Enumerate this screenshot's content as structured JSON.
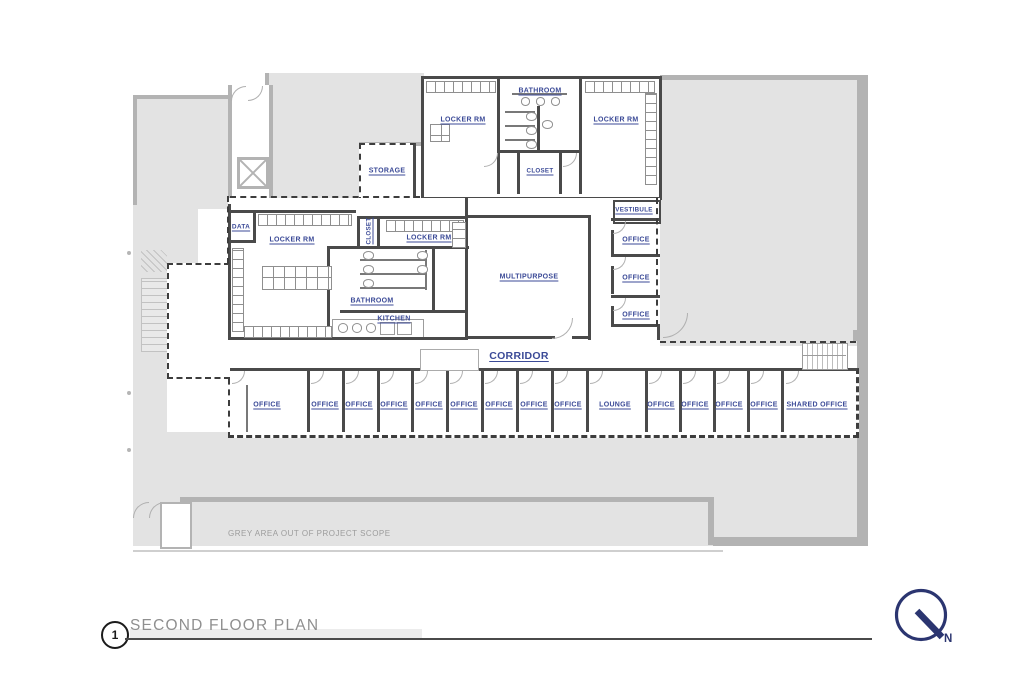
{
  "sheet": {
    "detail_number": "1",
    "title": "SECOND FLOOR PLAN",
    "north_label": "N",
    "scope_note": "GREY AREA OUT OF PROJECT SCOPE"
  },
  "colors": {
    "room_label": "#3b4a97",
    "wall": "#4a4a4a",
    "out_of_scope_fill": "#e3e3e3",
    "out_of_scope_wall": "#b3b3b3",
    "north_arrow": "#2b3570",
    "title_text": "#8f8f8f"
  },
  "rooms": [
    {
      "id": "locker-rm-top-left",
      "label": "LOCKER RM",
      "x": 463,
      "y": 120
    },
    {
      "id": "bathroom-top",
      "label": "BATHROOM",
      "x": 540,
      "y": 91
    },
    {
      "id": "locker-rm-top-right",
      "label": "LOCKER RM",
      "x": 616,
      "y": 120
    },
    {
      "id": "storage",
      "label": "STORAGE",
      "x": 387,
      "y": 171
    },
    {
      "id": "closet-top",
      "label": "CLOSET",
      "x": 540,
      "y": 171,
      "fs": 6.2
    },
    {
      "id": "vestibule",
      "label": "VESTIBULE",
      "x": 634,
      "y": 210,
      "fs": 6.2
    },
    {
      "id": "data",
      "label": "DATA",
      "x": 241,
      "y": 227,
      "fs": 6.5
    },
    {
      "id": "locker-rm-mid-left",
      "label": "LOCKER RM",
      "x": 292,
      "y": 240
    },
    {
      "id": "closet-mid",
      "label": "CLOSET",
      "x": 369,
      "y": 231,
      "fs": 6.2,
      "rot": -90
    },
    {
      "id": "locker-rm-mid-right",
      "label": "LOCKER RM",
      "x": 429,
      "y": 238
    },
    {
      "id": "office-east-1",
      "label": "OFFICE",
      "x": 636,
      "y": 240
    },
    {
      "id": "multipurpose",
      "label": "MULTIPURPOSE",
      "x": 529,
      "y": 277
    },
    {
      "id": "office-east-2",
      "label": "OFFICE",
      "x": 636,
      "y": 278
    },
    {
      "id": "bathroom-mid",
      "label": "BATHROOM",
      "x": 372,
      "y": 301
    },
    {
      "id": "office-east-3",
      "label": "OFFICE",
      "x": 636,
      "y": 315
    },
    {
      "id": "kitchen",
      "label": "KITCHEN",
      "x": 394,
      "y": 319
    },
    {
      "id": "corridor",
      "label": "CORRIDOR",
      "x": 519,
      "y": 356,
      "fs": 10.5
    },
    {
      "id": "office-s1",
      "label": "OFFICE",
      "x": 267,
      "y": 405
    },
    {
      "id": "office-s2",
      "label": "OFFICE",
      "x": 325,
      "y": 405
    },
    {
      "id": "office-s3",
      "label": "OFFICE",
      "x": 359,
      "y": 405
    },
    {
      "id": "office-s4",
      "label": "OFFICE",
      "x": 394,
      "y": 405
    },
    {
      "id": "office-s5",
      "label": "OFFICE",
      "x": 429,
      "y": 405
    },
    {
      "id": "office-s6",
      "label": "OFFICE",
      "x": 464,
      "y": 405
    },
    {
      "id": "office-s7",
      "label": "OFFICE",
      "x": 499,
      "y": 405
    },
    {
      "id": "office-s8",
      "label": "OFFICE",
      "x": 534,
      "y": 405
    },
    {
      "id": "office-s9",
      "label": "OFFICE",
      "x": 568,
      "y": 405
    },
    {
      "id": "lounge",
      "label": "LOUNGE",
      "x": 615,
      "y": 405
    },
    {
      "id": "office-s10",
      "label": "OFFICE",
      "x": 661,
      "y": 405
    },
    {
      "id": "office-s11",
      "label": "OFFICE",
      "x": 695,
      "y": 405
    },
    {
      "id": "office-s12",
      "label": "OFFICE",
      "x": 729,
      "y": 405
    },
    {
      "id": "office-s13",
      "label": "OFFICE",
      "x": 764,
      "y": 405
    },
    {
      "id": "shared-office",
      "label": "SHARED OFFICE",
      "x": 817,
      "y": 405
    }
  ]
}
